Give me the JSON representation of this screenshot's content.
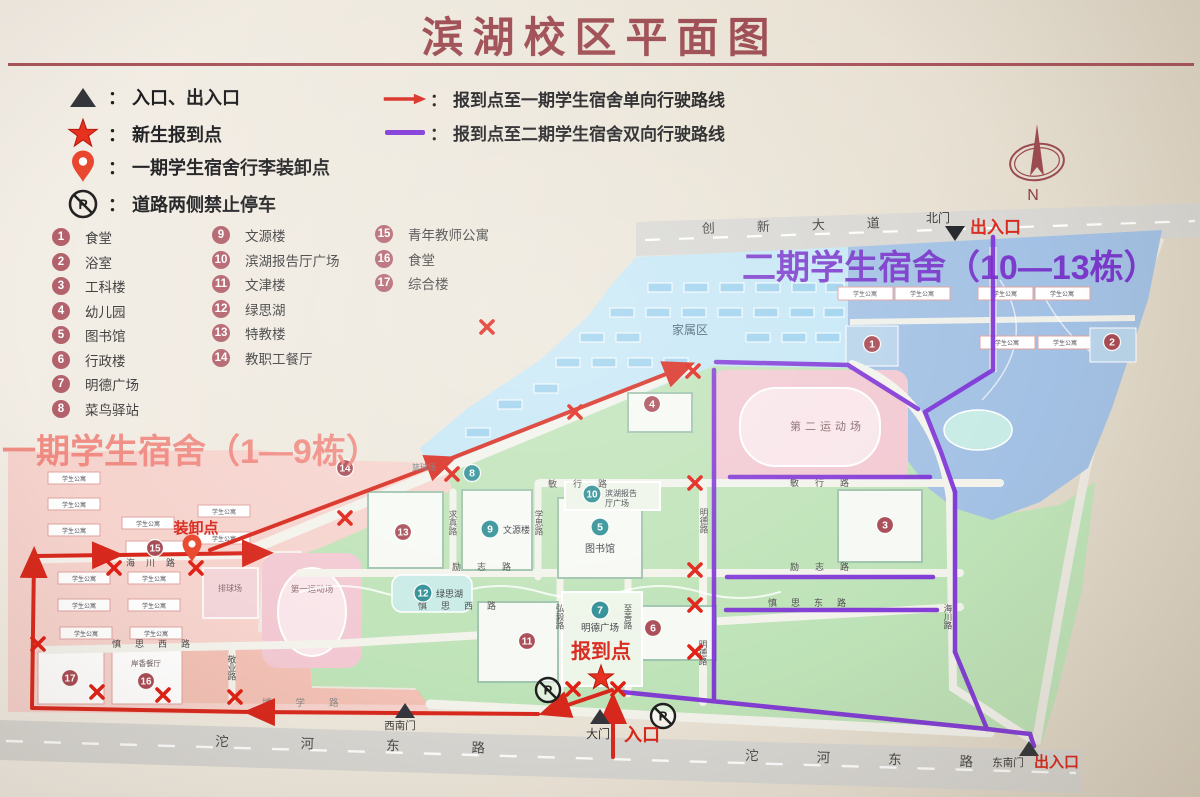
{
  "title": "滨湖校区平面图",
  "legend": {
    "separator": "：",
    "left": [
      {
        "label": "入口、出入口"
      },
      {
        "label": "新生报到点"
      },
      {
        "label": "一期学生宿舍行李装卸点"
      },
      {
        "label": "道路两侧禁止停车"
      }
    ],
    "right": [
      {
        "label": "报到点至一期学生宿舍单向行驶路线"
      },
      {
        "label": "报到点至二期学生宿舍双向行驶路线"
      }
    ]
  },
  "facilities": [
    {
      "num": "1",
      "label": "食堂"
    },
    {
      "num": "2",
      "label": "浴室"
    },
    {
      "num": "3",
      "label": "工科楼"
    },
    {
      "num": "4",
      "label": "幼儿园"
    },
    {
      "num": "5",
      "label": "图书馆"
    },
    {
      "num": "6",
      "label": "行政楼"
    },
    {
      "num": "7",
      "label": "明德广场"
    },
    {
      "num": "8",
      "label": "菜鸟驿站"
    },
    {
      "num": "9",
      "label": "文源楼"
    },
    {
      "num": "10",
      "label": "滨湖报告厅广场"
    },
    {
      "num": "11",
      "label": "文津楼"
    },
    {
      "num": "12",
      "label": "绿思湖"
    },
    {
      "num": "13",
      "label": "特教楼"
    },
    {
      "num": "14",
      "label": "教职工餐厅"
    },
    {
      "num": "15",
      "label": "青年教师公寓"
    },
    {
      "num": "16",
      "label": "食堂"
    },
    {
      "num": "17",
      "label": "综合楼"
    }
  ],
  "compass": {
    "n": "N"
  },
  "colors": {
    "accent_red": "#d8281c",
    "accent_purple": "#7c2fd6",
    "title_red": "#9c4a50"
  },
  "map": {
    "zones": {
      "phase2_title": "二期学生宿舍（10—13栋）",
      "phase1_title": "一期学生宿舍（1—9栋）",
      "family_area": "家属区"
    },
    "gates": {
      "north_gate": "北门",
      "north_exit": "出入口",
      "main_gate": "大门",
      "main_entrance": "入口",
      "southwest_gate": "西南门",
      "southeast_gate": "东南门",
      "southeast_exit": "出入口"
    },
    "points": {
      "report_point": "报到点",
      "unload_point": "装卸点"
    },
    "roads": {
      "chuangxin_avenue": "创新大道",
      "tuohe_east_road": "沱河东路",
      "minxing": "敏行路",
      "lizhi": "励志路",
      "shensi_west": "慎思西路",
      "shensi_east": "慎思东路",
      "haichuan": "海川路",
      "mingde": "明德路",
      "hongyi": "弘毅路",
      "zhishan": "至善路",
      "qiuzhen": "求真路",
      "xuesi": "学思路",
      "jingye": "敬业路",
      "boxue": "博学路"
    },
    "places": {
      "apartment": "学生公寓",
      "library": "图书馆",
      "wenyuan": "文源楼",
      "hall_line1": "滨湖报告",
      "hall_line2": "厅广场",
      "mingde_square": "明德广场",
      "lake": "绿思湖",
      "field1": "第一运动场",
      "field2": "第二运动场",
      "volleyball": "排球场",
      "basketball": "篮球场",
      "restaurant": "岸香餐厅"
    },
    "icons": {
      "no_parking_letter": "P"
    }
  }
}
